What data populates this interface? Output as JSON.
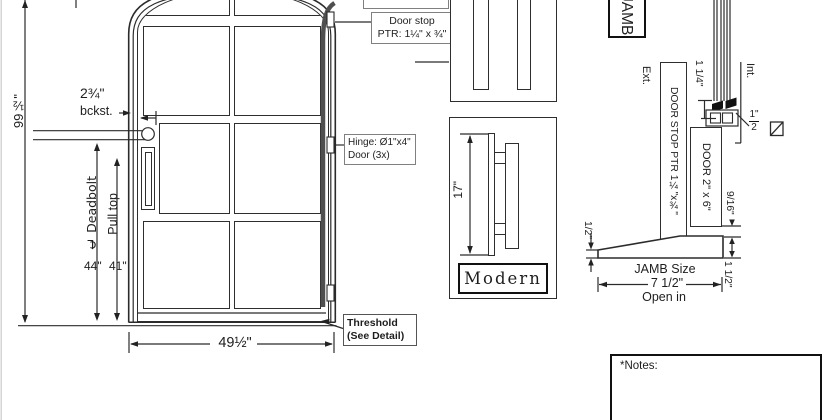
{
  "door_elevation": {
    "height_dim": "99½\"",
    "backset_dim": "2¾\"",
    "backset_label": "bckst.",
    "deadbolt_label": "℄ Deadbolt",
    "pull_top_label": "Pull top",
    "deadbolt_height_dim": "44\"",
    "pull_height_dim": "41\"",
    "width_dim": "49½\"",
    "door_stop_callout": {
      "line1": "Door stop",
      "line2": "PTR: 1¼\" x ¾\""
    },
    "hinge_callout": {
      "line1": "Hinge: Ø1\"x4\"",
      "line2": "Door (3x)"
    },
    "threshold_callout": {
      "line1": "Threshold",
      "line2": "(See Detail)"
    }
  },
  "handle_detail": {
    "length_dim": "17\"",
    "style_label": "Modern"
  },
  "jamb_detail": {
    "title": "JAMB",
    "exterior_label": "Ext.",
    "interior_label": "Int.",
    "door_stop_label": "DOOR STOP PTR 1¼\"x¾\"",
    "door_label": "DOOR 2\" x 6\"",
    "stop_height_dim": "1 1/4\"",
    "seal_dim_numerator": "1\"",
    "seal_dim_denominator": "2",
    "threshold_lip_dim": "1/2\"",
    "door_gap_dim": "9/16\"",
    "threshold_height_dim": "1 1/2\"",
    "jamb_size_label": "JAMB Size",
    "jamb_size_dim": "7 1/2\"",
    "swing_label": "Open in"
  },
  "notes": {
    "label": "*Notes:"
  }
}
